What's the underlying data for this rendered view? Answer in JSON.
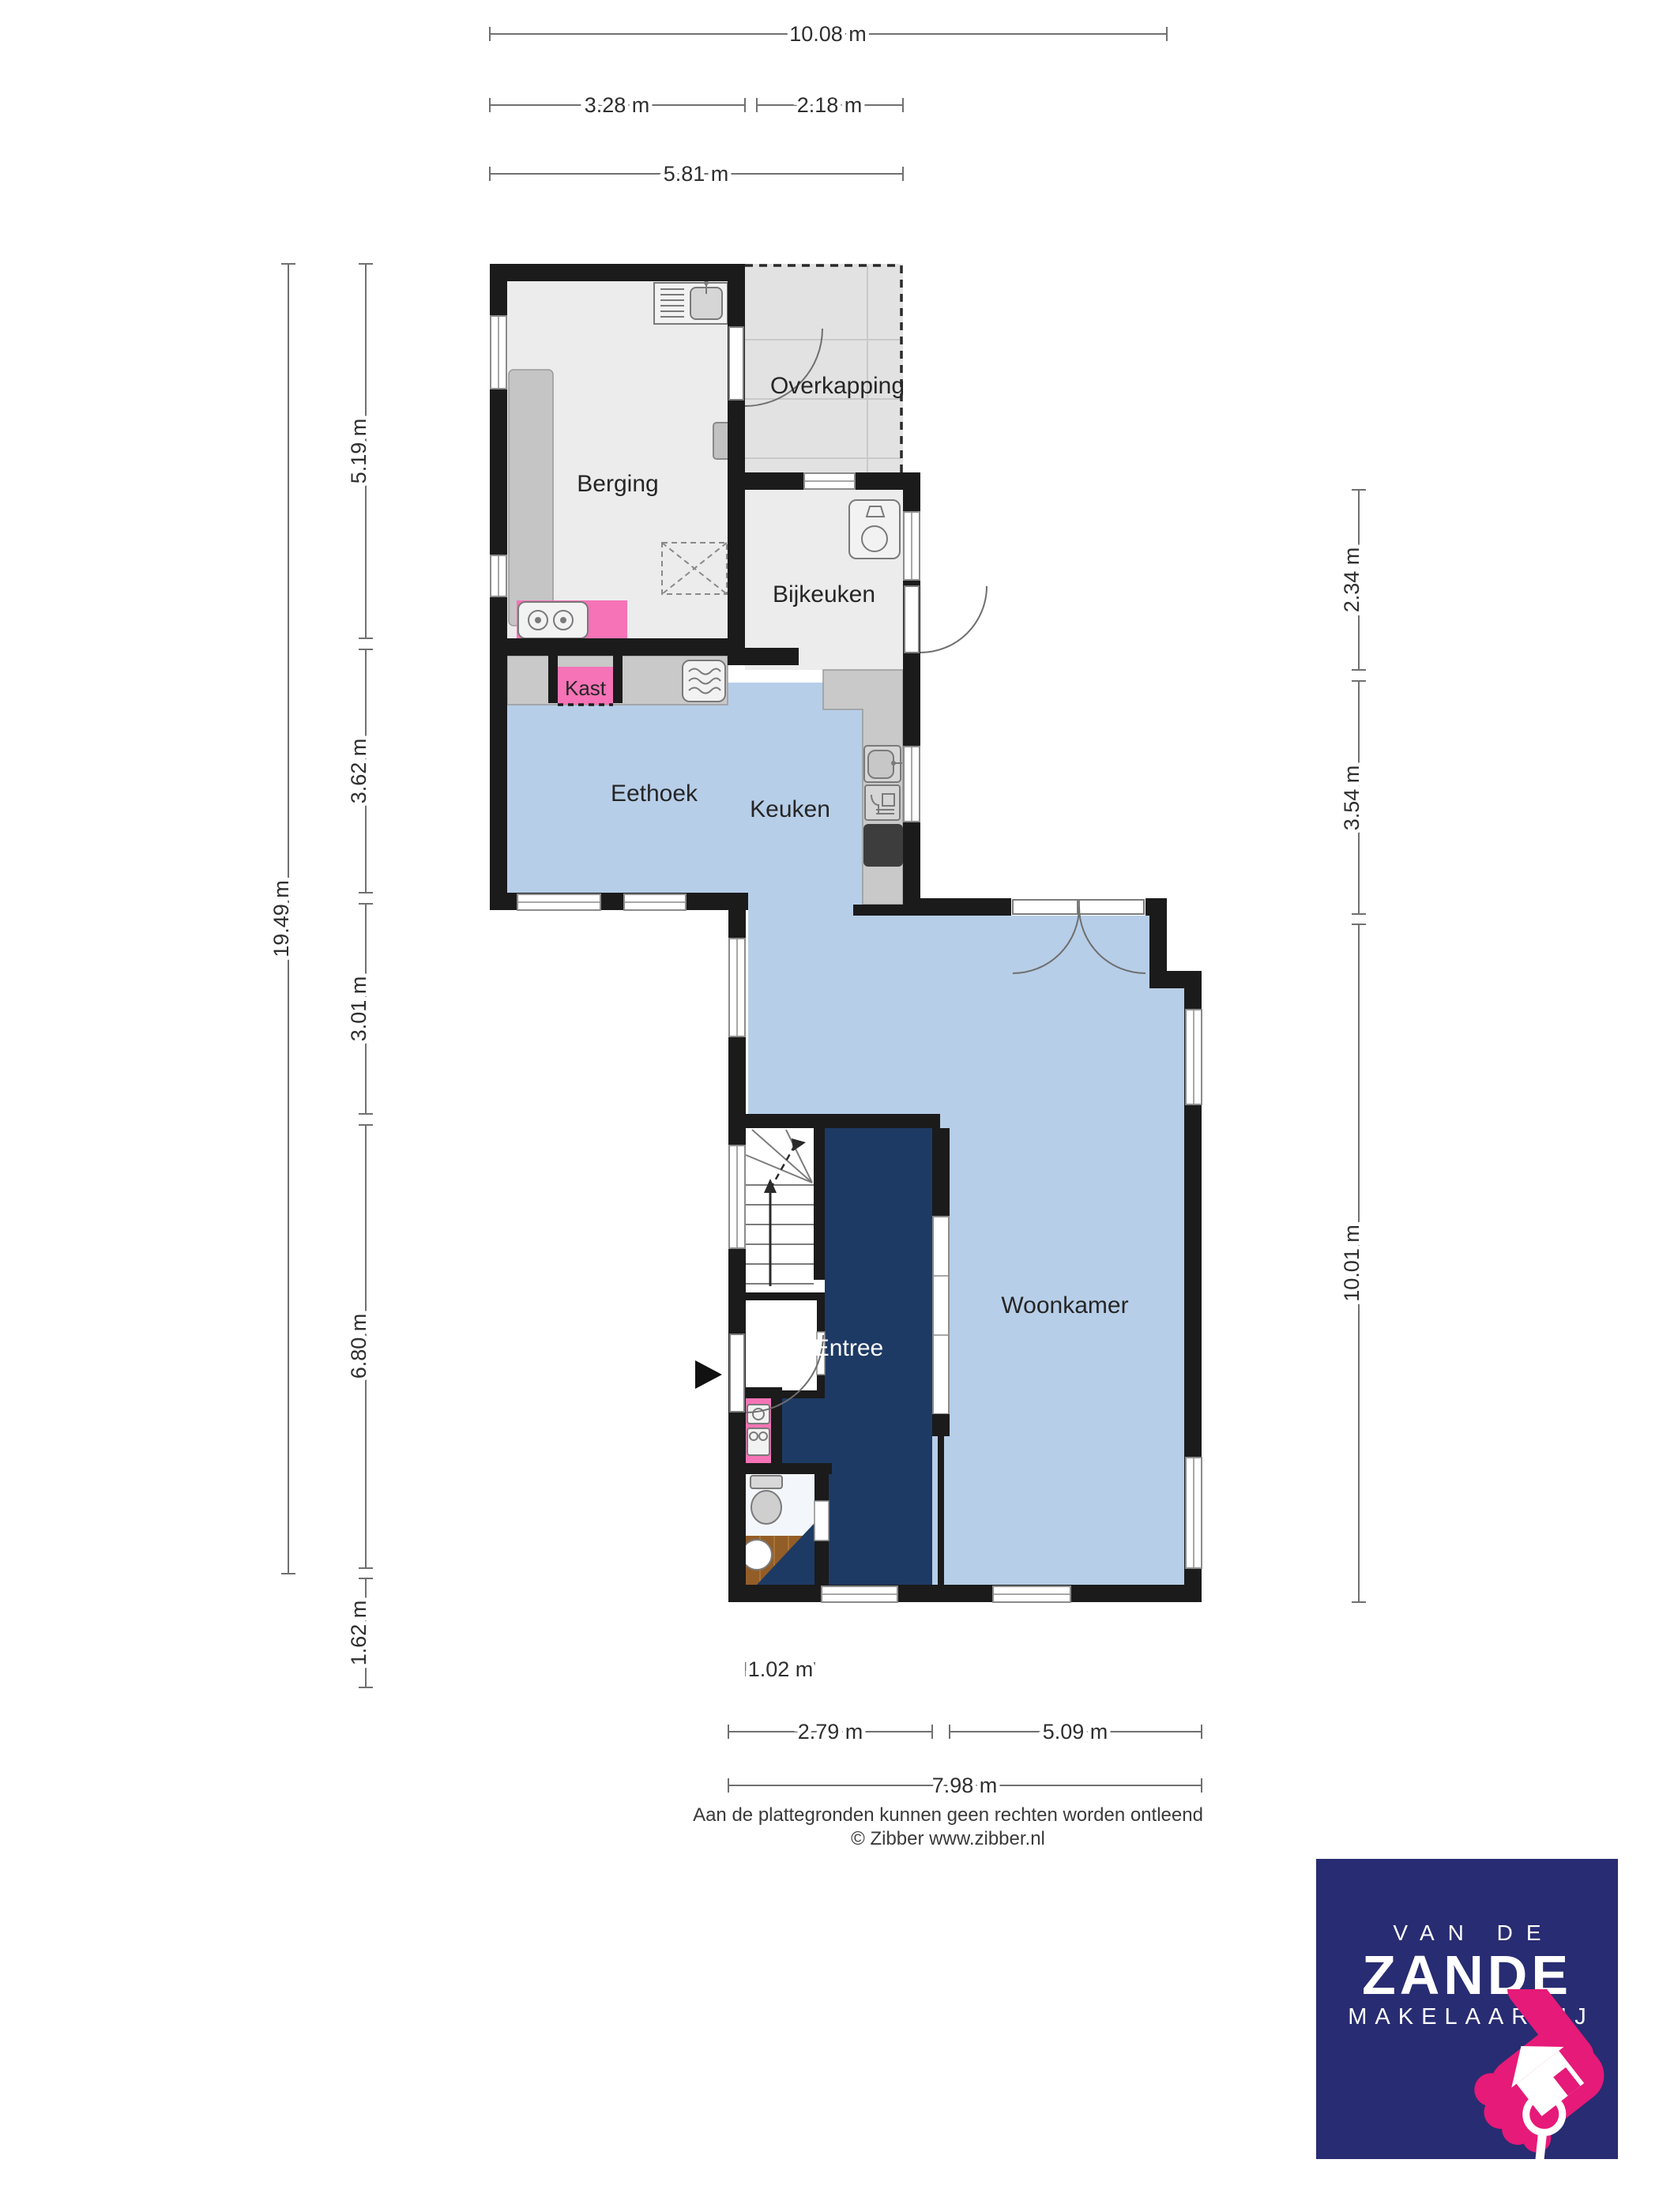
{
  "rooms": {
    "overkapping": "Overkapping",
    "berging": "Berging",
    "bijkeuken": "Bijkeuken",
    "eethoek": "Eethoek",
    "keuken": "Keuken",
    "kast": "Kast",
    "entree": "Entree",
    "woonkamer": "Woonkamer"
  },
  "dimensions": {
    "top_total": "10.08 m",
    "top_berging": "3.28 m",
    "top_overkapping": "2.18 m",
    "top_combined": "5.81 m",
    "left_total": "19.49 m",
    "left_berging": "5.19 m",
    "left_eethoek": "3.62 m",
    "left_middle": "3.01 m",
    "left_entree": "6.80 m",
    "left_toilet": "1.62 m",
    "right_bijkeuken": "2.34 m",
    "right_middle": "3.54 m",
    "right_woonkamer": "10.01 m",
    "bottom_toilet": "1.02 m",
    "bottom_entree": "2.79 m",
    "bottom_woonkamer": "5.09 m",
    "bottom_total": "7.98 m"
  },
  "footer": {
    "line1": "Aan de plattegronden kunnen geen rechten worden ontleend",
    "line2": "© Zibber www.zibber.nl"
  },
  "logo": {
    "line1": "VAN DE",
    "line2": "ZANDE",
    "line3": "MAKELAARDIJ"
  },
  "colors": {
    "wall": "#1b1b1b",
    "floor-gray": "#ececec",
    "floor-gray-dark": "#e2e2e2",
    "counter": "#c9c9c9",
    "floor-blue": "#b7cee8",
    "floor-navy": "#1d3a64",
    "pink": "#f573b6",
    "wood": "#935d28",
    "stove": "#3d3d3d",
    "logo-navy": "#282c72",
    "logo-pink": "#e61a78"
  }
}
